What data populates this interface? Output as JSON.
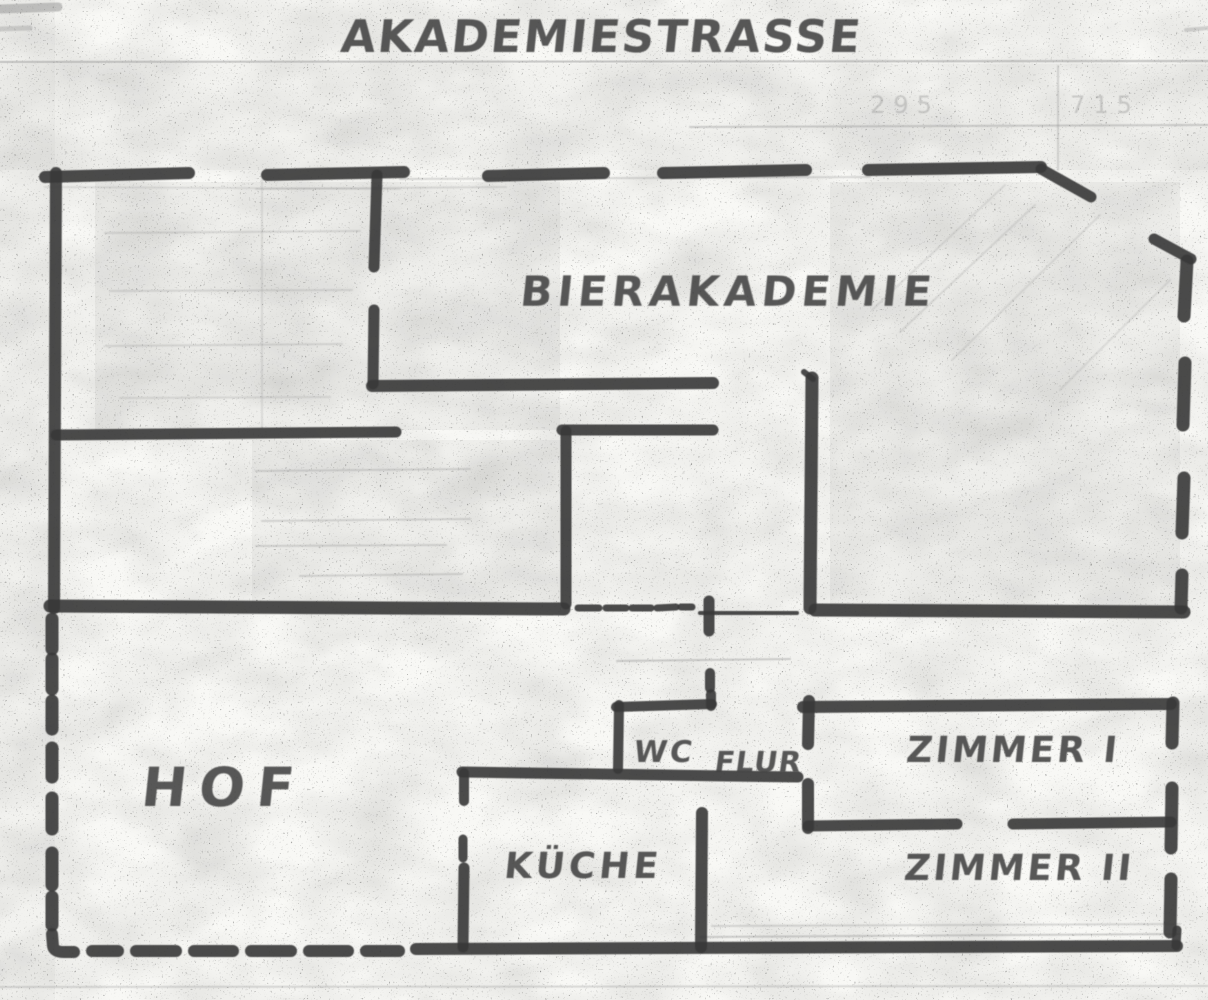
{
  "labels": {
    "street": "AKADEMIESTRASSE",
    "building": "BIERAKADEMIE",
    "courtyard": "HOF",
    "wc": "WC",
    "hallway": "FLUR",
    "room_1": "ZIMMER I",
    "room_2": "ZIMMER II",
    "kitchen": "KÜCHE"
  },
  "ghost_marks": {
    "left": "295",
    "right": "715"
  },
  "colors": {
    "ink": "#3a3a3a",
    "paper": "#f8f8f5",
    "ghost_gray": "#8f8f8f"
  }
}
